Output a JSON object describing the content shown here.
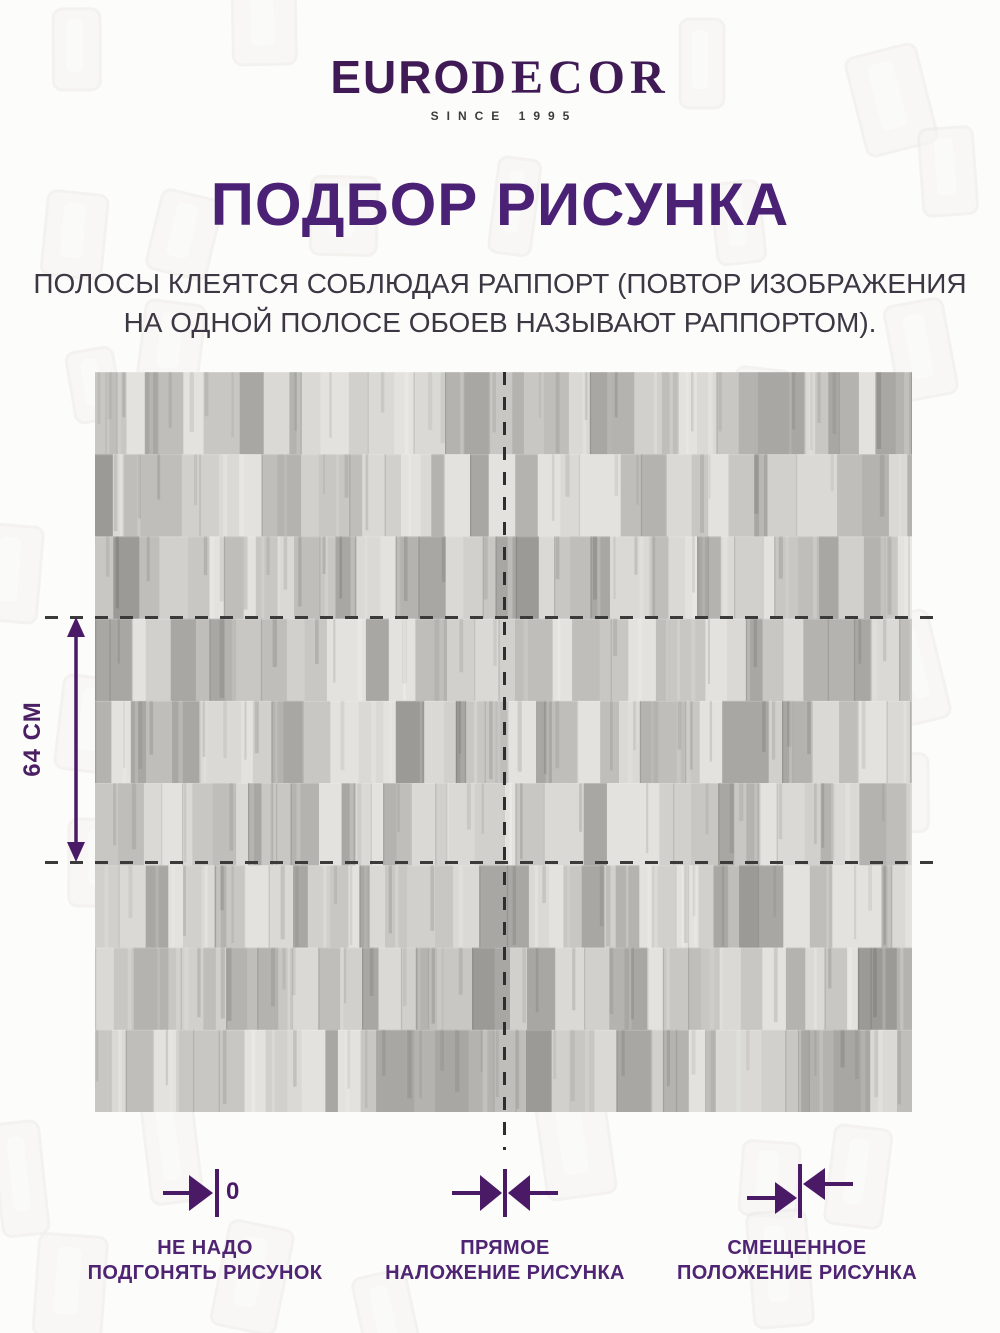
{
  "brand": {
    "name_euro": "EURO",
    "name_decor": "DECOR",
    "tagline": "SINCE 1995"
  },
  "title": "ПОДБОР РИСУНКА",
  "description": {
    "line1": "ПОЛОСЫ КЛЕЯТСЯ СОБЛЮДАЯ РАППОРТ (ПОВТОР ИЗОБРАЖЕНИЯ",
    "line2": "НА ОДНОЙ ПОЛОСЕ ОБОЕВ НАЗЫВАЮТ РАППОРТОМ)."
  },
  "diagram": {
    "rapport_label": "64 СМ",
    "zero_label": "0"
  },
  "legend": {
    "no_match": {
      "line1": "НЕ НАДО",
      "line2": "ПОДГОНЯТЬ РИСУНОК"
    },
    "straight_match": {
      "line1": "ПРЯМОЕ",
      "line2": "НАЛОЖЕНИЕ РИСУНКА"
    },
    "offset_match": {
      "line1": "СМЕЩЕННОЕ",
      "line2": "ПОЛОЖЕНИЕ РИСУНКА"
    }
  },
  "colors": {
    "brand_purple": "#3f1a55",
    "accent_purple": "#4b2175",
    "arrow_purple": "#4a1a66",
    "text_dark": "#3d3744",
    "dash_color": "#3a3a3a",
    "wallpaper_base": "#cfceca",
    "wallpaper_grays": [
      "#e3e2de",
      "#dad9d5",
      "#d1d0cc",
      "#c8c7c3",
      "#bfbeba",
      "#b4b3af",
      "#a8a7a3"
    ]
  }
}
